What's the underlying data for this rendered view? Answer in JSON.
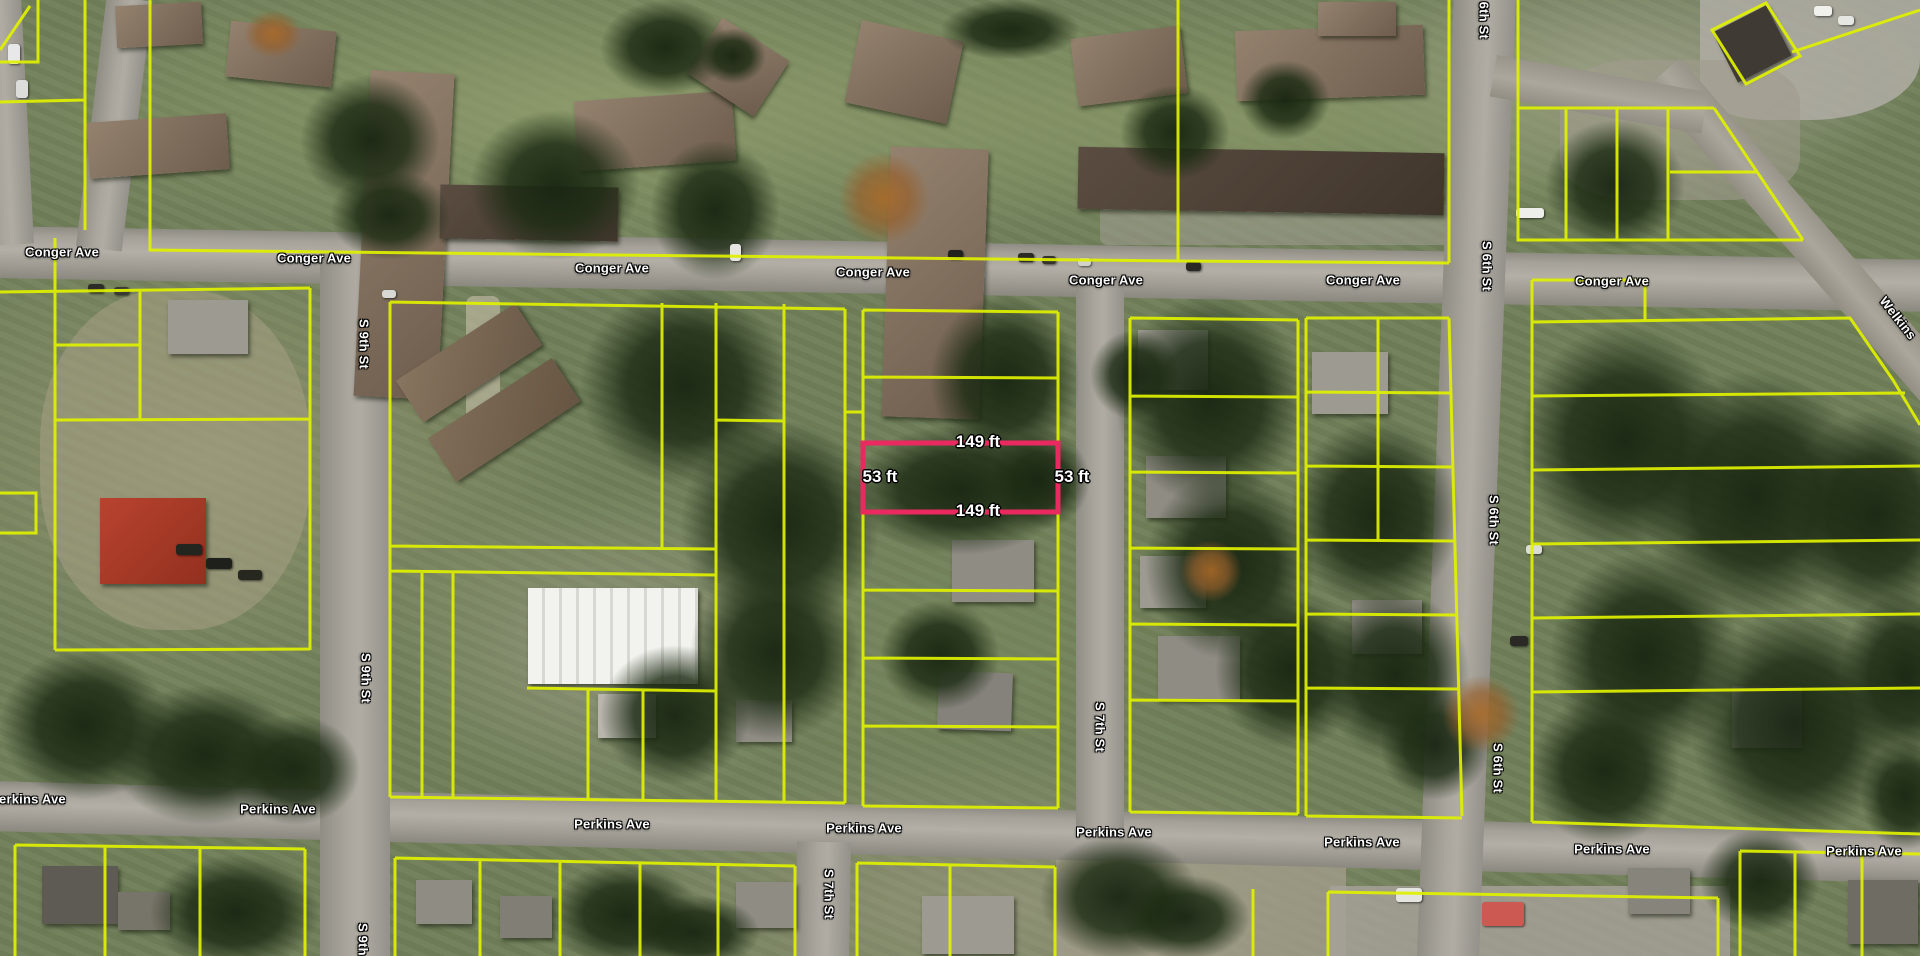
{
  "map": {
    "type": "satellite-parcel-map",
    "street_labels": [
      {
        "text": "Conger Ave",
        "x": 62,
        "y": 252,
        "rot": 0
      },
      {
        "text": "Conger Ave",
        "x": 314,
        "y": 258,
        "rot": 0
      },
      {
        "text": "Conger Ave",
        "x": 612,
        "y": 268,
        "rot": 0
      },
      {
        "text": "Conger Ave",
        "x": 873,
        "y": 272,
        "rot": 0
      },
      {
        "text": "Conger Ave",
        "x": 1106,
        "y": 280,
        "rot": 0
      },
      {
        "text": "Conger Ave",
        "x": 1363,
        "y": 280,
        "rot": 0
      },
      {
        "text": "Conger Ave",
        "x": 1612,
        "y": 281,
        "rot": 0
      },
      {
        "text": "Perkins Ave",
        "x": 28,
        "y": 799,
        "rot": 0
      },
      {
        "text": "Perkins Ave",
        "x": 278,
        "y": 809,
        "rot": 0
      },
      {
        "text": "Perkins Ave",
        "x": 612,
        "y": 824,
        "rot": 0
      },
      {
        "text": "Perkins Ave",
        "x": 864,
        "y": 828,
        "rot": 0
      },
      {
        "text": "Perkins Ave",
        "x": 1114,
        "y": 832,
        "rot": 0
      },
      {
        "text": "Perkins Ave",
        "x": 1362,
        "y": 842,
        "rot": 0
      },
      {
        "text": "Perkins Ave",
        "x": 1612,
        "y": 849,
        "rot": 0
      },
      {
        "text": "Perkins Ave",
        "x": 1864,
        "y": 851,
        "rot": 0
      },
      {
        "text": "S 9th St",
        "x": 364,
        "y": 344,
        "rot": 90
      },
      {
        "text": "S 9th St",
        "x": 366,
        "y": 678,
        "rot": 90
      },
      {
        "text": "S 9th St",
        "x": 363,
        "y": 948,
        "rot": 90
      },
      {
        "text": "S 7th St",
        "x": 1100,
        "y": 727,
        "rot": 90
      },
      {
        "text": "S 7th St",
        "x": 829,
        "y": 894,
        "rot": 90
      },
      {
        "text": "S 6th St",
        "x": 1484,
        "y": 14,
        "rot": 90
      },
      {
        "text": "S 6th St",
        "x": 1487,
        "y": 266,
        "rot": 90
      },
      {
        "text": "S 6th St",
        "x": 1494,
        "y": 520,
        "rot": 90
      },
      {
        "text": "S 6th St",
        "x": 1498,
        "y": 768,
        "rot": 90
      },
      {
        "text": "Welkins",
        "x": 1898,
        "y": 318,
        "rot": 52
      }
    ],
    "selected_parcel": {
      "outline_color": "#e9295f",
      "x": 863,
      "y": 443,
      "width": 195,
      "height": 69,
      "dimension_labels": [
        {
          "text": "149 ft",
          "x": 978,
          "y": 442
        },
        {
          "text": "53 ft",
          "x": 880,
          "y": 477
        },
        {
          "text": "53 ft",
          "x": 1072,
          "y": 477
        },
        {
          "text": "149 ft",
          "x": 978,
          "y": 511
        }
      ]
    },
    "parcel_line_color": "#dff000"
  }
}
